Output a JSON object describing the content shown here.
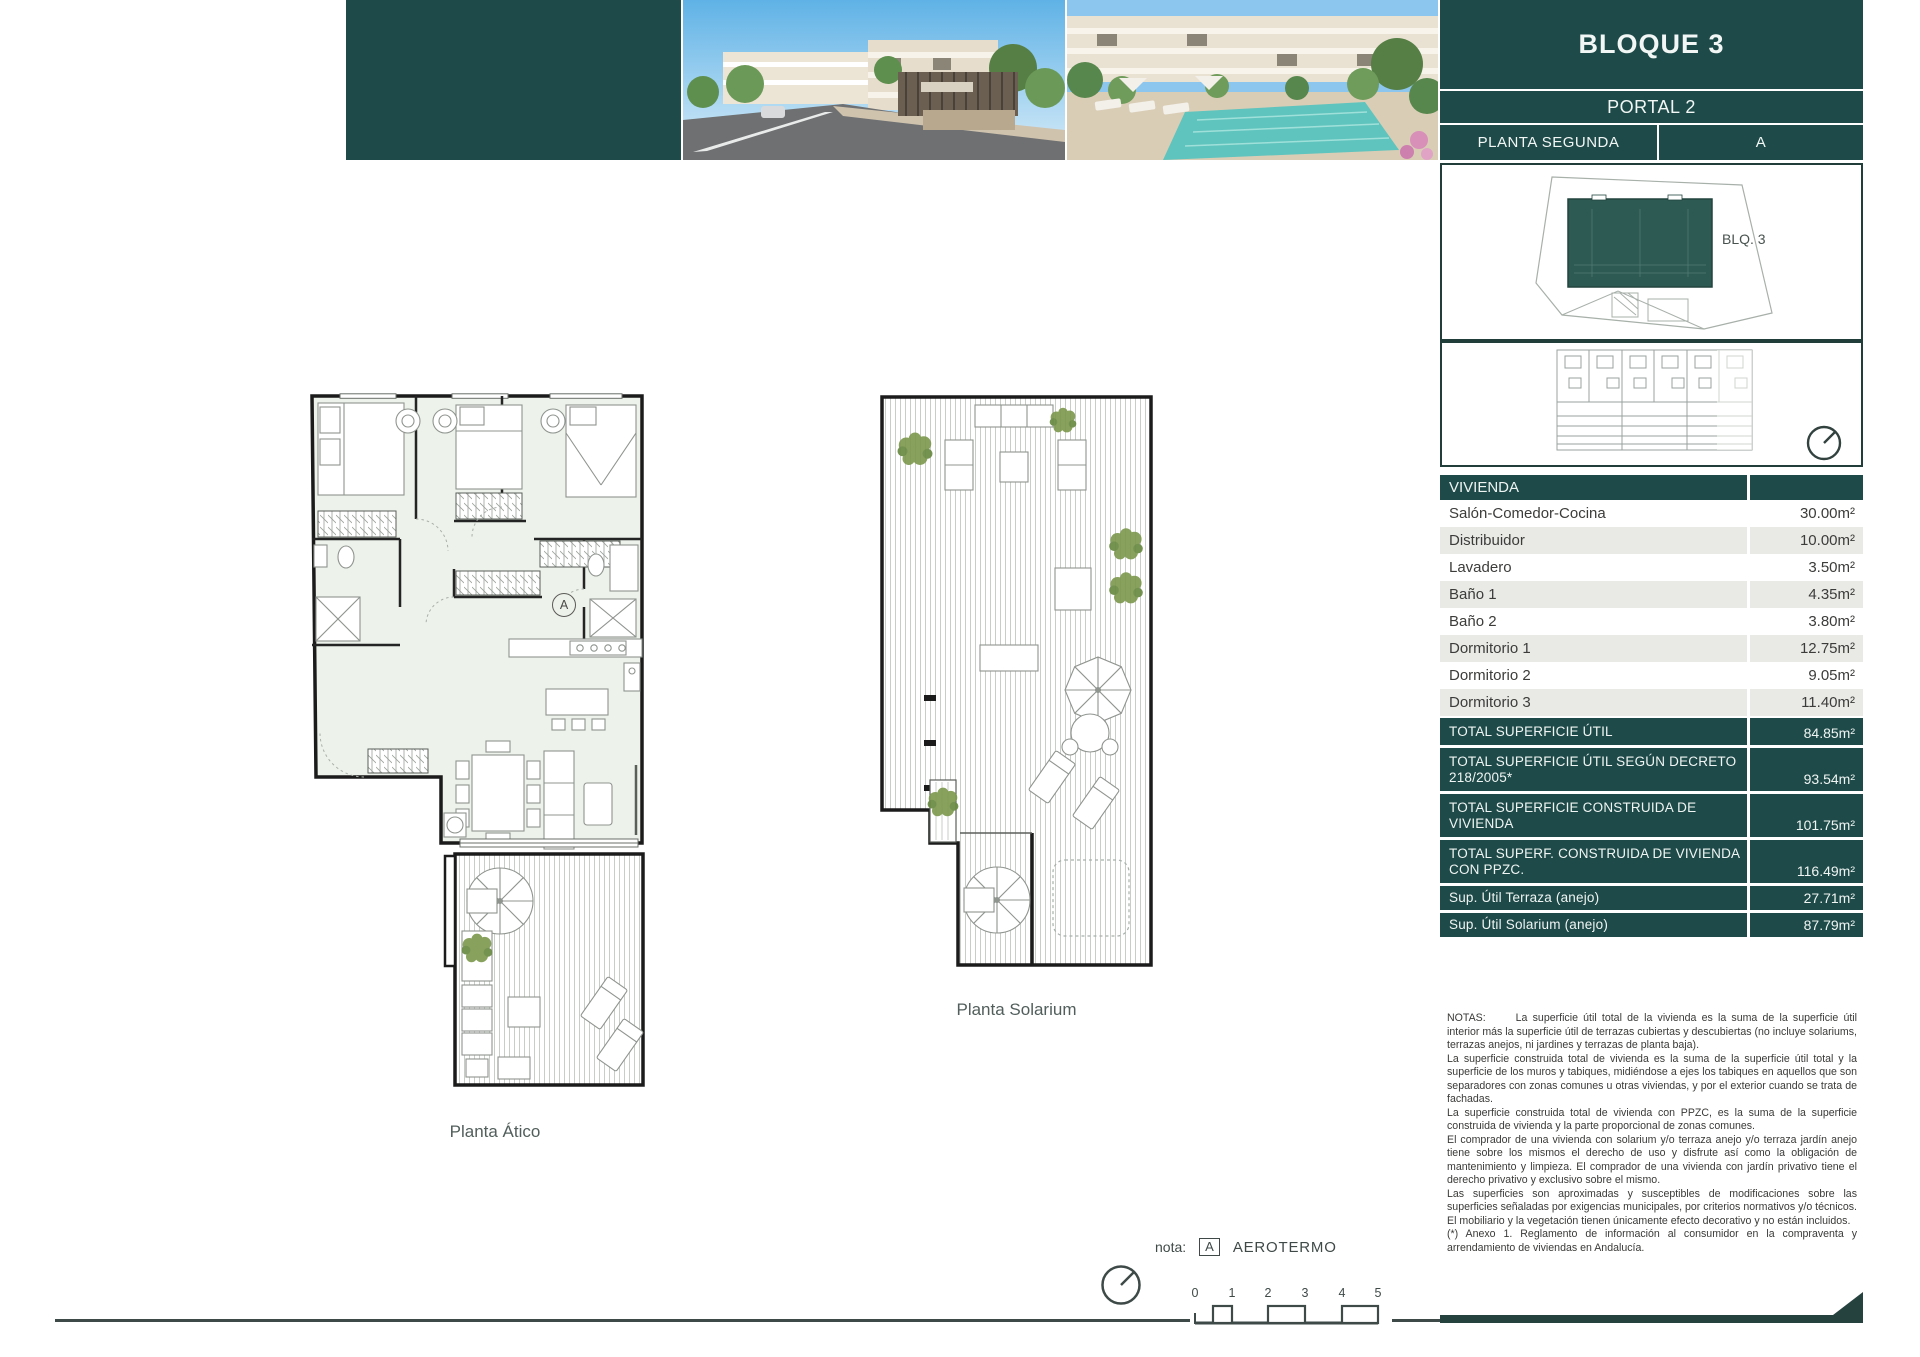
{
  "colors": {
    "accent_teal": "#1e4a49",
    "row_alt_gray": "#e9e9e6",
    "plan_fill_green": "#edf2ea",
    "pool_turquoise": "#5fc4bd"
  },
  "header": {
    "block_title": "BLOQUE 3",
    "portal": "PORTAL 2",
    "planta": "PLANTA SEGUNDA",
    "unit": "A"
  },
  "site_inset": {
    "building_label": "BLQ. 3"
  },
  "vivienda": {
    "title": "VIVIENDA",
    "rows": [
      {
        "label": "Salón-Comedor-Cocina",
        "value": "30.00m²"
      },
      {
        "label": "Distribuidor",
        "value": "10.00m²"
      },
      {
        "label": "Lavadero",
        "value": "3.50m²"
      },
      {
        "label": "Baño 1",
        "value": "4.35m²"
      },
      {
        "label": "Baño 2",
        "value": "3.80m²"
      },
      {
        "label": "Dormitorio 1",
        "value": "12.75m²"
      },
      {
        "label": "Dormitorio 2",
        "value": "9.05m²"
      },
      {
        "label": "Dormitorio 3",
        "value": "11.40m²"
      }
    ],
    "totals": [
      {
        "label": "TOTAL SUPERFICIE ÚTIL",
        "value": "84.85m²"
      },
      {
        "label": "TOTAL SUPERFICIE ÚTIL SEGÚN DECRETO 218/2005*",
        "value": "93.54m²"
      },
      {
        "label": "TOTAL SUPERFICIE CONSTRUIDA DE VIVIENDA",
        "value": "101.75m²"
      },
      {
        "label": "TOTAL SUPERF. CONSTRUIDA DE VIVIENDA CON PPZC.",
        "value": "116.49m²"
      },
      {
        "label": "Sup. Útil Terraza (anejo)",
        "value": "27.71m²"
      },
      {
        "label": "Sup. Útil Solarium (anejo)",
        "value": "87.79m²"
      }
    ]
  },
  "plans": {
    "atico_label": "Planta Ático",
    "solarium_label": "Planta Solarium",
    "aerotermo_marker": "A"
  },
  "notes": {
    "label": "NOTAS:",
    "paragraphs": [
      "La superficie útil total de la vivienda es la suma de la superficie útil interior más la superficie útil de terrazas cubiertas y descubiertas (no incluye solariums, terrazas anejos, ni jardines y terrazas de planta baja).",
      "La superficie construida total de vivienda es la suma de la superficie útil total y la superficie de los muros y tabiques, midiéndose a ejes los tabiques en aquellos que son separadores con zonas comunes u otras viviendas, y por el exterior cuando se trata de fachadas.",
      "La superficie construida total de vivienda con PPZC, es la suma de la superficie construida de vivienda y la parte proporcional de zonas comunes.",
      "El comprador de una vivienda con solarium y/o terraza anejo y/o terraza jardín anejo tiene sobre los mismos el derecho de uso y disfrute así como la obligación de mantenimiento y limpieza. El comprador de una vivienda con jardín privativo tiene el derecho privativo y exclusivo sobre el mismo.",
      "Las superficies son aproximadas y susceptibles de modificaciones sobre las superficies señaladas por exigencias municipales, por criterios normativos y/o técnicos. El mobiliario y la vegetación tienen únicamente efecto decorativo y no están incluidos.",
      "(*) Anexo 1. Reglamento de información al consumidor en la compraventa y arrendamiento de viviendas en Andalucía."
    ]
  },
  "footer": {
    "nota_label": "nota:",
    "marker": "A",
    "marker_label": "AEROTERMO",
    "scale_ticks": [
      "0",
      "1",
      "2",
      "3",
      "4",
      "5"
    ]
  }
}
